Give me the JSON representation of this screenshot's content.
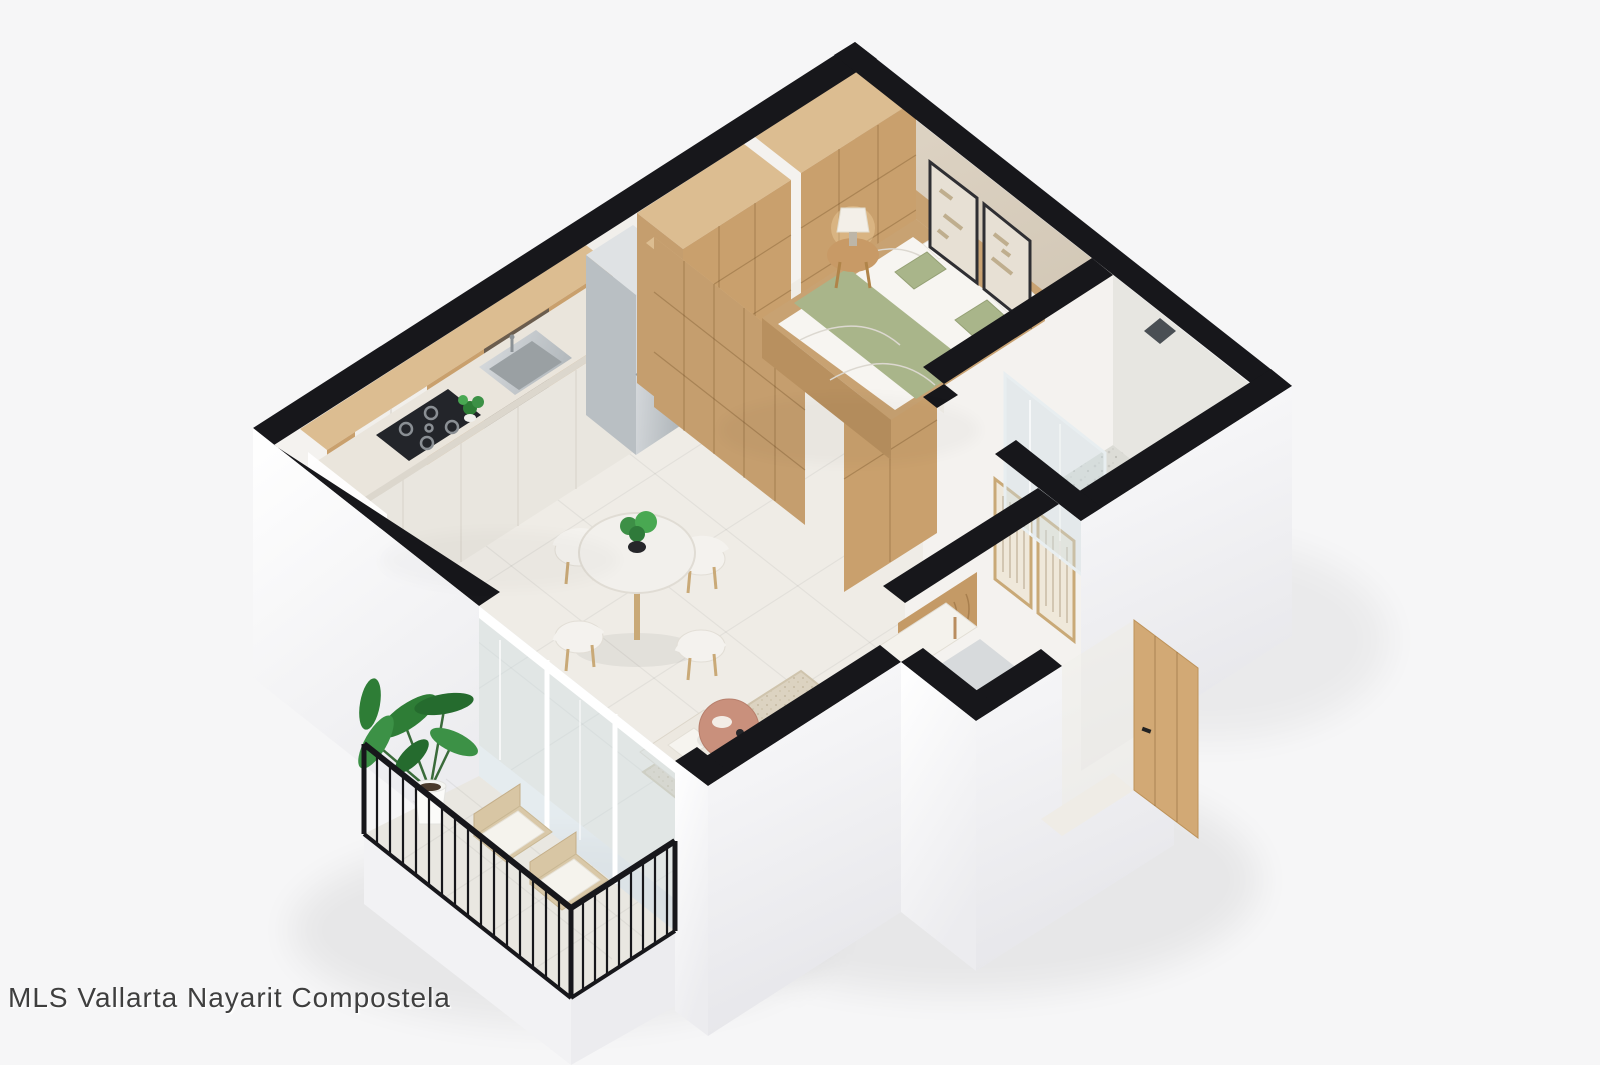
{
  "watermark": {
    "text": "MLS Vallarta Nayarit Compostela"
  },
  "scene": {
    "kind": "isometric-3d-floor-plan-render",
    "rooms": [
      "bedroom",
      "bathroom",
      "kitchen",
      "living-dining",
      "entry-hall",
      "balcony"
    ],
    "furniture": [
      "wardrobe",
      "double-bed",
      "nightstand-with-lamp",
      "wall-art",
      "kitchen-cabinets",
      "gas-cooktop",
      "kitchen-sink",
      "refrigerator",
      "dining-table",
      "dining-chairs",
      "sofa",
      "area-rug",
      "coffee-table",
      "accent-bench",
      "laundry-cabinet",
      "entry-door",
      "walk-in-shower",
      "balcony-lounge-chairs",
      "potted-plant",
      "sheer-curtain"
    ]
  },
  "colors": {
    "bg": "#f6f6f7",
    "wall_top": "#17171b",
    "int_wall": "#f4f2ef",
    "accent_wall": "#d9cfc0",
    "floor": "#efece6",
    "bath_floor": "#e4e3de",
    "balcony_floor": "#e9e7e1",
    "wood": "#c9a06d",
    "wood_light": "#dcbd91",
    "wood_mid": "#c59e6e",
    "steel": "#c9ced2",
    "white_cab": "#f1efeb",
    "counter": "#eae5dc",
    "sofa": "#ece8e0",
    "rug": "#dcd3c1",
    "sage": "#a9b58a",
    "green": "#2e7d36",
    "terracotta": "#c9907c",
    "glass": "rgba(205,222,228,0.42)",
    "watermark": "#3f3f3f"
  }
}
